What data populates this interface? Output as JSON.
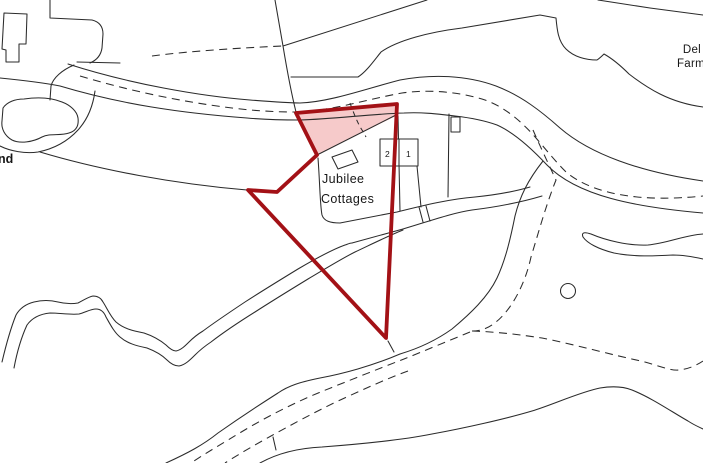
{
  "map": {
    "labels": {
      "property_name_line1": "Jubilee",
      "property_name_line2": "Cottages",
      "plot_number_left": "2",
      "plot_number_right": "1",
      "farm_name_line1": "Del",
      "farm_name_line2": "Farm",
      "left_edge_truncated_label": "nd"
    },
    "colors": {
      "boundary_red": "#a31116",
      "boundary_fill_pink": "#f6caca",
      "line_black": "#2b2b2b",
      "background": "#ffffff"
    }
  }
}
